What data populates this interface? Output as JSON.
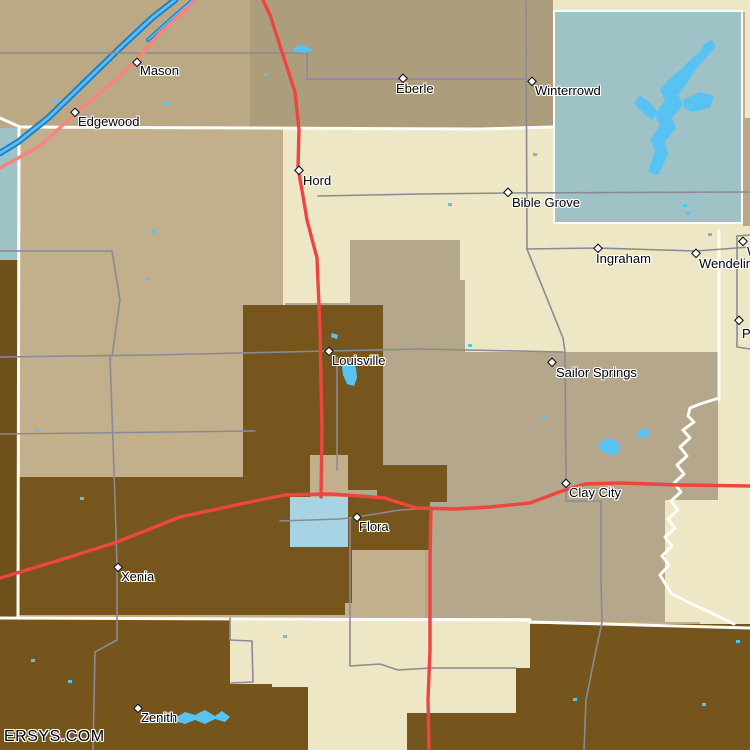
{
  "watermark": "ERSYS.COM",
  "colors": {
    "tan_base": "#C2B08C",
    "tan_top_w": "#BAA984",
    "tan_top_e": "#AC9E7C",
    "tan_strip": "#B9A883",
    "cream": "#EDE7C5",
    "graytan": "#B5A78B",
    "bluegray": "#9FC2C6",
    "blue_block": "#A7D4E4",
    "brown": "#76561C",
    "brown_dark": "#6F511B",
    "brown_bottom": "#75551B",
    "lake": "#58C3F3",
    "river_dark": "#1B7FC6",
    "river_light": "#5FBCEE",
    "road_red": "#EF4540",
    "road_pink": "#F9837F",
    "road_gray": "#8A8A96",
    "boundary_white": "#FDFDF8",
    "label_color": "#000000"
  },
  "map": {
    "regions": [
      {
        "name": "top-w",
        "x": 0,
        "y": 0,
        "w": 250,
        "h": 128,
        "color": "tan_top_w"
      },
      {
        "name": "top-e",
        "x": 250,
        "y": 0,
        "w": 305,
        "h": 128,
        "color": "tan_top_e"
      },
      {
        "name": "cream-top",
        "x": 553,
        "y": 0,
        "w": 197,
        "h": 12,
        "color": "cream"
      },
      {
        "name": "cream-right-sliver",
        "x": 745,
        "y": 10,
        "w": 5,
        "h": 110,
        "color": "cream"
      },
      {
        "name": "cream-band",
        "x": 283,
        "y": 128,
        "w": 467,
        "h": 232,
        "color": "cream"
      },
      {
        "name": "cream-right",
        "x": 700,
        "y": 230,
        "w": 50,
        "h": 395,
        "color": "cream"
      },
      {
        "name": "cream-se",
        "x": 665,
        "y": 360,
        "w": 85,
        "h": 262,
        "color": "cream"
      },
      {
        "name": "graytan-lobe",
        "x": 350,
        "y": 240,
        "w": 110,
        "h": 63,
        "color": "graytan"
      },
      {
        "name": "graytan-lobe2",
        "x": 400,
        "y": 280,
        "w": 65,
        "h": 72,
        "color": "graytan"
      },
      {
        "name": "graytan-west",
        "x": 285,
        "y": 303,
        "w": 175,
        "h": 50,
        "color": "graytan"
      },
      {
        "name": "graytan-band",
        "x": 285,
        "y": 352,
        "w": 433,
        "h": 148,
        "color": "graytan"
      },
      {
        "name": "graytan-low",
        "x": 425,
        "y": 500,
        "w": 240,
        "h": 122,
        "color": "graytan"
      },
      {
        "name": "bluegray-left",
        "x": 0,
        "y": 128,
        "w": 20,
        "h": 132,
        "color": "bluegray"
      },
      {
        "name": "brown-left",
        "x": 0,
        "y": 260,
        "w": 18,
        "h": 358,
        "color": "brown_dark"
      },
      {
        "name": "bluegray-square",
        "x": 553,
        "y": 10,
        "w": 190,
        "h": 214,
        "color": "bluegray",
        "border": true
      },
      {
        "name": "tan-strip-right",
        "x": 743,
        "y": 118,
        "w": 7,
        "h": 108,
        "color": "tan_strip"
      },
      {
        "name": "brown-louisville",
        "x": 243,
        "y": 305,
        "w": 140,
        "h": 185,
        "color": "brown"
      },
      {
        "name": "brown-xenia",
        "x": 18,
        "y": 477,
        "w": 327,
        "h": 138,
        "color": "brown"
      },
      {
        "name": "tan-notch",
        "x": 310,
        "y": 455,
        "w": 38,
        "h": 42,
        "color": "tan_base"
      },
      {
        "name": "brown-flora-n",
        "x": 377,
        "y": 465,
        "w": 70,
        "h": 37,
        "color": "brown"
      },
      {
        "name": "brown-flora",
        "x": 348,
        "y": 497,
        "w": 82,
        "h": 53,
        "color": "brown"
      },
      {
        "name": "blue-flora",
        "x": 290,
        "y": 497,
        "w": 58,
        "h": 50,
        "color": "blue_block"
      },
      {
        "name": "brown-flora-s",
        "x": 280,
        "y": 547,
        "w": 72,
        "h": 56,
        "color": "brown"
      },
      {
        "name": "brown-bottom-left",
        "x": 0,
        "y": 618,
        "w": 280,
        "h": 132,
        "color": "brown_bottom"
      },
      {
        "name": "cream-bottom",
        "x": 272,
        "y": 618,
        "w": 258,
        "h": 132,
        "color": "cream"
      },
      {
        "name": "brown-bottom-right",
        "x": 530,
        "y": 624,
        "w": 220,
        "h": 126,
        "color": "brown_bottom"
      },
      {
        "name": "brown-strip-mid",
        "x": 516,
        "y": 668,
        "w": 16,
        "h": 82,
        "color": "brown_bottom"
      },
      {
        "name": "brown-bottom-mid",
        "x": 407,
        "y": 713,
        "w": 125,
        "h": 37,
        "color": "brown_bottom"
      },
      {
        "name": "cream-pocket",
        "x": 230,
        "y": 620,
        "w": 46,
        "h": 64,
        "color": "cream"
      },
      {
        "name": "brown-pocket",
        "x": 230,
        "y": 687,
        "w": 78,
        "h": 63,
        "color": "brown_bottom"
      }
    ],
    "boundaries_white": [
      {
        "name": "county-line-north",
        "points": "20,127 480,129 553,127"
      },
      {
        "name": "county-line-nw",
        "points": "0,118 20,127"
      },
      {
        "name": "county-line-west",
        "points": "19,127 18,618"
      },
      {
        "name": "county-line-south-a",
        "points": "0,618 530,620"
      },
      {
        "name": "county-line-south-b",
        "points": "530,622 750,628"
      },
      {
        "name": "county-line-east",
        "points": "719,231 719,400"
      },
      {
        "name": "river-boundary",
        "points": "719,398 700,404 690,408 688,416 694,422 683,430 690,438 680,447 687,456 677,465 684,474 674,483 681,492 671,501 678,510 668,519 675,528 665,537 672,546 662,556 669,565 660,575 666,585 672,594 688,602 705,610 722,618 734,624"
      }
    ],
    "roads_gray": [
      {
        "name": "road-mason-east",
        "points": "0,53 307,53 307,79 526,79"
      },
      {
        "name": "road-winterrowd-vertical",
        "points": "526,0 527,249"
      },
      {
        "name": "road-bible-grove",
        "points": "318,196 420,194 508,193 750,192"
      },
      {
        "name": "road-ingraham-wendelin",
        "points": "527,249 598,248 696,251 750,247"
      },
      {
        "name": "road-sailor-springs-diag",
        "points": "527,249 563,338 565,352 566,483"
      },
      {
        "name": "road-clay-city-south",
        "points": "566,483 566,501 601,501 601,580 602,622 594,660 586,700 584,750"
      },
      {
        "name": "road-louisville-horiz",
        "points": "0,357 150,355 329,351 420,349 563,352"
      },
      {
        "name": "road-xenia-vertical",
        "points": "110,356 115,500 117,567 117,640 95,652 93,750"
      },
      {
        "name": "road-west-mid",
        "points": "0,251 112,251 120,300 112,356"
      },
      {
        "name": "road-west-lower",
        "points": "0,434 255,431"
      },
      {
        "name": "road-louisville-south",
        "points": "337,357 337,470"
      },
      {
        "name": "road-flora-horiz",
        "points": "280,521 340,519 357,517 400,510 417,509"
      },
      {
        "name": "road-flora-south",
        "points": "350,519 350,666 380,664 398,670 430,668 516,668"
      },
      {
        "name": "road-east-box-v",
        "points": "737,236 737,347 750,349"
      },
      {
        "name": "road-east-box-h",
        "points": "737,236 750,235"
      },
      {
        "name": "road-pocket-edge",
        "points": "230,618 230,640 252,641 253,682 231,683"
      }
    ],
    "roads_red": [
      {
        "name": "highway-north-south",
        "points": "263,0 270,15 295,92 299,130 298,168 303,196 307,220 317,258 320,330 322,430 321,497"
      },
      {
        "name": "highway-flora-clay-city",
        "points": "0,578 60,560 117,542 180,517 250,502 285,495 330,494 360,496 385,498 400,503 417,508 455,509 490,507 530,503 562,491 585,484 620,483 680,485 750,486"
      },
      {
        "name": "highway-south",
        "points": "431,509 430,560 430,650 428,700 429,750"
      }
    ],
    "roads_pink": [
      {
        "name": "highway-mason-edgewood",
        "points": "196,0 160,33 135,62 98,95 77,112 40,146 0,168"
      }
    ],
    "rivers": [
      {
        "name": "river-main",
        "points": "175,0 152,18 120,48 85,82 48,118 18,142 0,153",
        "w_dark": 6.5,
        "w_light": 2.8
      },
      {
        "name": "river-branch",
        "points": "193,0 170,20 148,40",
        "w_dark": 4,
        "w_light": 1.6
      }
    ],
    "lakes": [
      {
        "name": "lake-branched-main",
        "points": "648,172 655,150 650,140 660,125 655,115 665,100 660,90 670,78 680,70 690,60 700,52 706,58 695,70 688,82 678,95 683,105 672,118 676,128 665,142 668,155 658,175"
      },
      {
        "name": "lake-branched-west-arm",
        "points": "640,95 650,103 658,112 652,120 642,112 634,103"
      },
      {
        "name": "lake-branched-east-blob",
        "points": "683,100 700,92 714,96 710,108 692,112 684,108"
      },
      {
        "name": "lake-branched-north-tip",
        "points": "700,52 704,44 712,40 716,46 708,56 704,60"
      },
      {
        "name": "pond-louisville",
        "points": "344,363 352,361 356,368 357,378 354,386 347,384 343,375 342,367"
      },
      {
        "name": "pond-louisville-small",
        "points": "332,333 338,335 337,339 331,337"
      },
      {
        "name": "lake-zenith",
        "points": "175,718 185,712 195,715 205,710 215,716 222,711 230,717 225,722 215,719 205,724 195,720 185,724 178,722"
      },
      {
        "name": "pond-clay-city",
        "points": "598,445 606,438 616,440 621,448 614,456 602,452"
      },
      {
        "name": "pond-clay-city-small",
        "points": "637,433 643,428 650,431 647,437 639,438"
      },
      {
        "name": "pond-hord",
        "points": "292,49 300,45 308,47 313,50 305,53 296,52"
      }
    ],
    "specks": [
      [
        53,
        100
      ],
      [
        163,
        102
      ],
      [
        533,
        153
      ],
      [
        152,
        230
      ],
      [
        146,
        277
      ],
      [
        35,
        429
      ],
      [
        80,
        497
      ],
      [
        542,
        415
      ],
      [
        573,
        698
      ],
      [
        702,
        703
      ],
      [
        736,
        640
      ],
      [
        283,
        635
      ],
      [
        31,
        659
      ],
      [
        68,
        680
      ],
      [
        264,
        73
      ],
      [
        468,
        344
      ],
      [
        683,
        204
      ],
      [
        686,
        212
      ],
      [
        708,
        233
      ],
      [
        448,
        203
      ]
    ],
    "towns": [
      {
        "name": "Mason",
        "mx": 137,
        "my": 62,
        "lx": 140,
        "ly": 64
      },
      {
        "name": "Edgewood",
        "mx": 75,
        "my": 112,
        "lx": 78,
        "ly": 115
      },
      {
        "name": "Eberle",
        "mx": 403,
        "my": 78,
        "lx": 396,
        "ly": 82
      },
      {
        "name": "Winterrowd",
        "mx": 532,
        "my": 81,
        "lx": 535,
        "ly": 84
      },
      {
        "name": "Hord",
        "mx": 299,
        "my": 170,
        "lx": 303,
        "ly": 174
      },
      {
        "name": "Bible Grove",
        "mx": 508,
        "my": 192,
        "lx": 512,
        "ly": 196
      },
      {
        "name": "Ingraham",
        "mx": 598,
        "my": 248,
        "lx": 596,
        "ly": 252
      },
      {
        "name": "Wendelin",
        "mx": 696,
        "my": 253,
        "lx": 699,
        "ly": 257
      },
      {
        "name": "W",
        "mx": 743,
        "my": 241,
        "lx": 747,
        "ly": 245
      },
      {
        "name": "P",
        "mx": 739,
        "my": 320,
        "lx": 742,
        "ly": 327
      },
      {
        "name": "Louisville",
        "mx": 329,
        "my": 351,
        "lx": 332,
        "ly": 354
      },
      {
        "name": "Sailor Springs",
        "mx": 552,
        "my": 362,
        "lx": 556,
        "ly": 366
      },
      {
        "name": "Clay City",
        "mx": 566,
        "my": 483,
        "lx": 569,
        "ly": 486
      },
      {
        "name": "Flora",
        "mx": 357,
        "my": 517,
        "lx": 359,
        "ly": 520
      },
      {
        "name": "Xenia",
        "mx": 118,
        "my": 567,
        "lx": 121,
        "ly": 570
      },
      {
        "name": "Zenith",
        "mx": 138,
        "my": 708,
        "lx": 141,
        "ly": 711
      }
    ]
  }
}
